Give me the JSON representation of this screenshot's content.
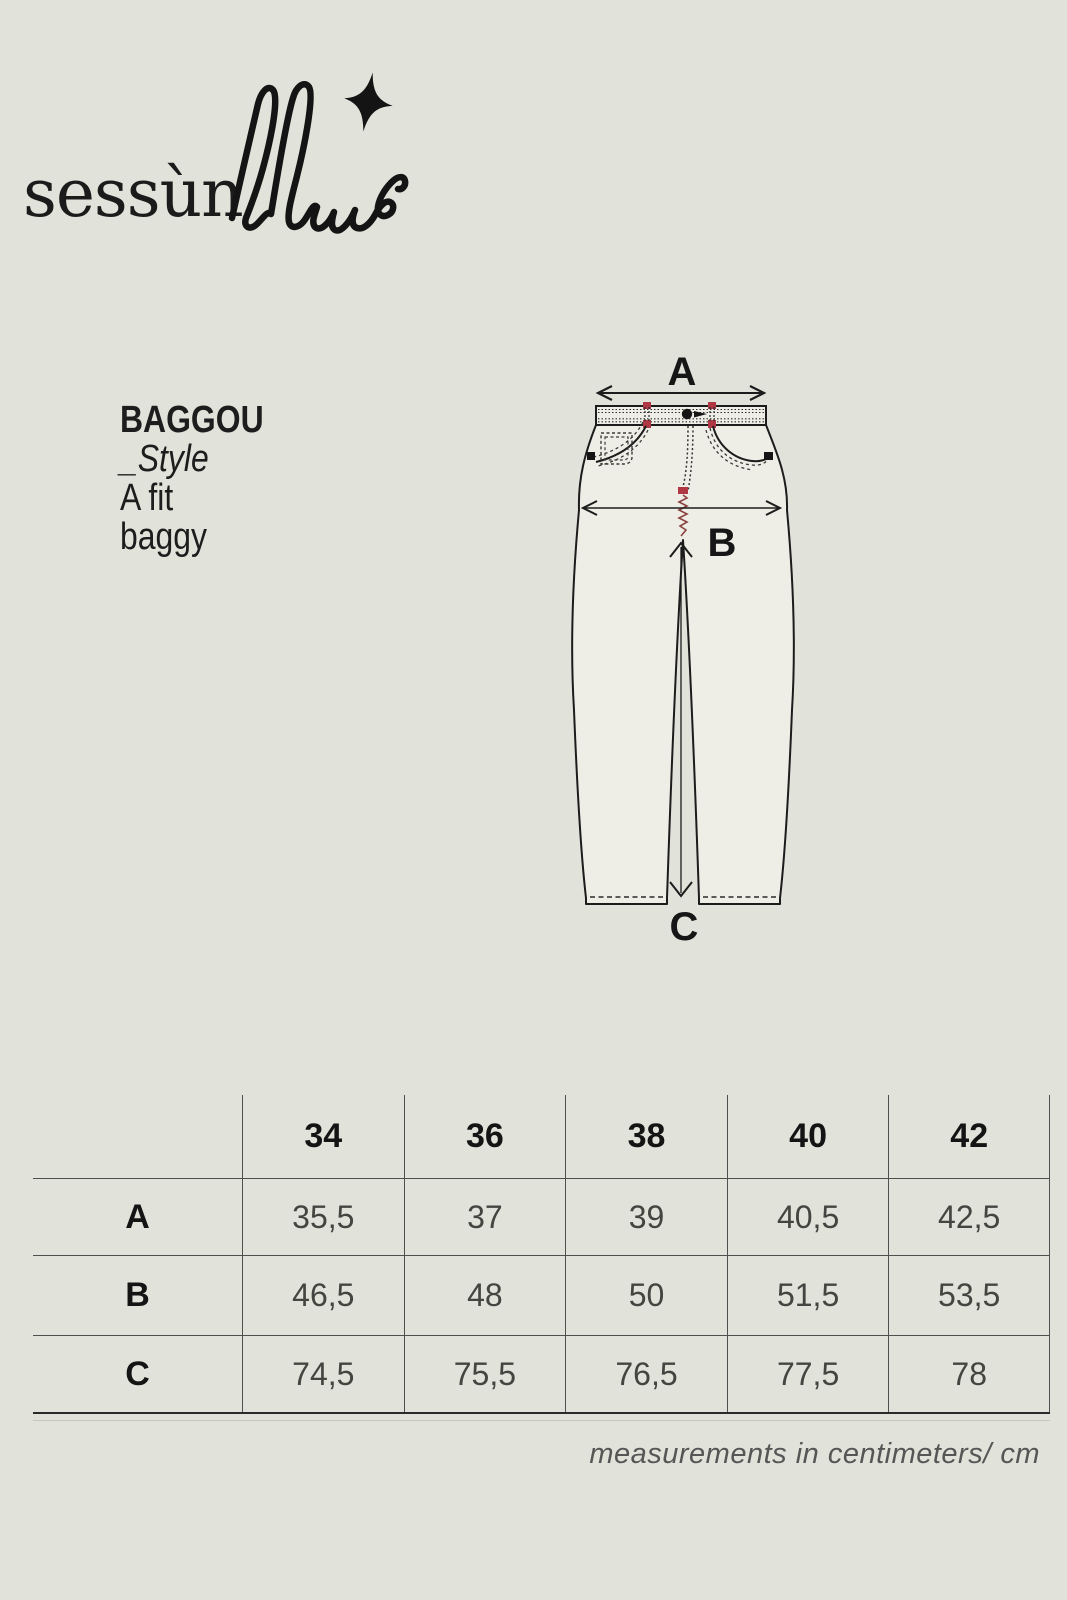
{
  "page": {
    "background_color": "#e1e2da",
    "ink_color": "#1b1b1b",
    "accent_red": "#b03744",
    "denim_fill": "#efeee6"
  },
  "logo": {
    "brand": "sessùn",
    "script": "blue",
    "star_icon": "four-point-star"
  },
  "style_info": {
    "name": "BAGGOU",
    "label": "_Style",
    "fit_line1": "A fit",
    "fit_line2": "baggy"
  },
  "diagram": {
    "garment": "baggy jeans technical flat drawing",
    "label_a": "A",
    "label_b": "B",
    "label_c": "C"
  },
  "size_table": {
    "sizes": [
      "34",
      "36",
      "38",
      "40",
      "42"
    ],
    "rows": [
      {
        "label": "A",
        "values": [
          "35,5",
          "37",
          "39",
          "40,5",
          "42,5"
        ]
      },
      {
        "label": "B",
        "values": [
          "46,5",
          "48",
          "50",
          "51,5",
          "53,5"
        ]
      },
      {
        "label": "C",
        "values": [
          "74,5",
          "75,5",
          "76,5",
          "77,5",
          "78"
        ]
      }
    ]
  },
  "footer": {
    "note": "measurements in centimeters/ cm"
  }
}
